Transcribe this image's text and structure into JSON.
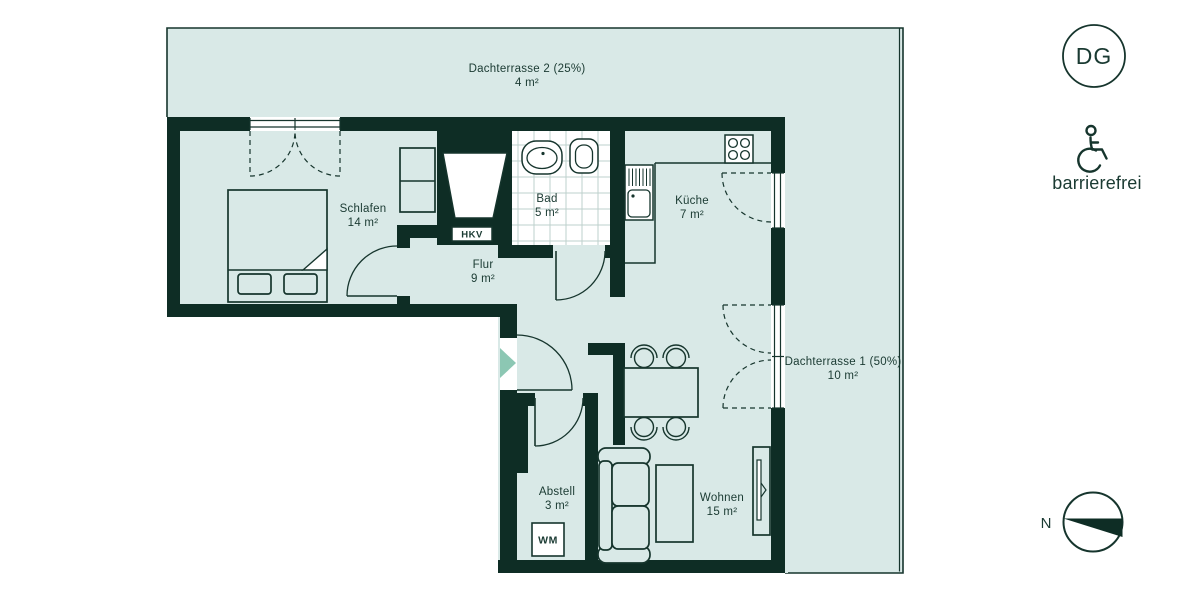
{
  "plan": {
    "rooms": [
      {
        "key": "schlafen",
        "label": "Schlafen",
        "area": "14 m²"
      },
      {
        "key": "bad",
        "label": "Bad",
        "area": "5 m²"
      },
      {
        "key": "kueche",
        "label": "Küche",
        "area": "7 m²"
      },
      {
        "key": "flur",
        "label": "Flur",
        "area": "9 m²"
      },
      {
        "key": "abstell",
        "label": "Abstell",
        "area": "3 m²"
      },
      {
        "key": "wohnen",
        "label": "Wohnen",
        "area": "15 m²"
      }
    ],
    "terraces": [
      {
        "key": "dachterrasse-2",
        "label": "Dachterrasse 2 (25%)",
        "area": "4 m²"
      },
      {
        "key": "dachterrasse-1",
        "label": "Dachterrasse 1 (50%)",
        "area": "10 m²"
      }
    ],
    "fixtures": {
      "hkv": "HKV",
      "wm": "WM"
    }
  },
  "badges": {
    "floor_level": "DG",
    "accessibility": "barrierefrei",
    "compass_north": "N"
  },
  "colors": {
    "wall": "#0e2d25",
    "floor": "#d9e9e7",
    "outline": "#16352d",
    "text": "#1a3a32",
    "entry_arrow": "#8cc7b3",
    "tile_grid": "#bdd0cc",
    "background": "#ffffff"
  }
}
